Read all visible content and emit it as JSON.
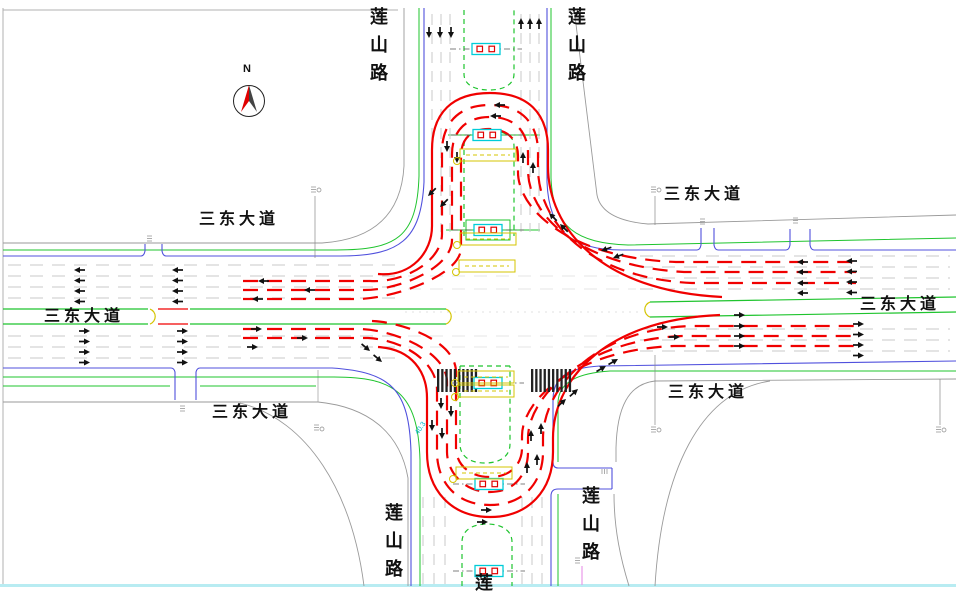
{
  "drawing": {
    "compass_label": "N",
    "road_ns": "莲山路",
    "road_ew": "三东大道",
    "road_ns_partial": "莲",
    "measurement": "40.3"
  },
  "colors": {
    "path_red": "#f00000",
    "curb_blue": "#5050dd",
    "edge_green": "#1fc42e",
    "signal_cyan": "#00ccd8",
    "annotation_yellow": "#d4c400",
    "border_cyan": "#b8ecf2",
    "compass_red": "#e00000",
    "sidewalk_gray": "#9a9a9a"
  }
}
